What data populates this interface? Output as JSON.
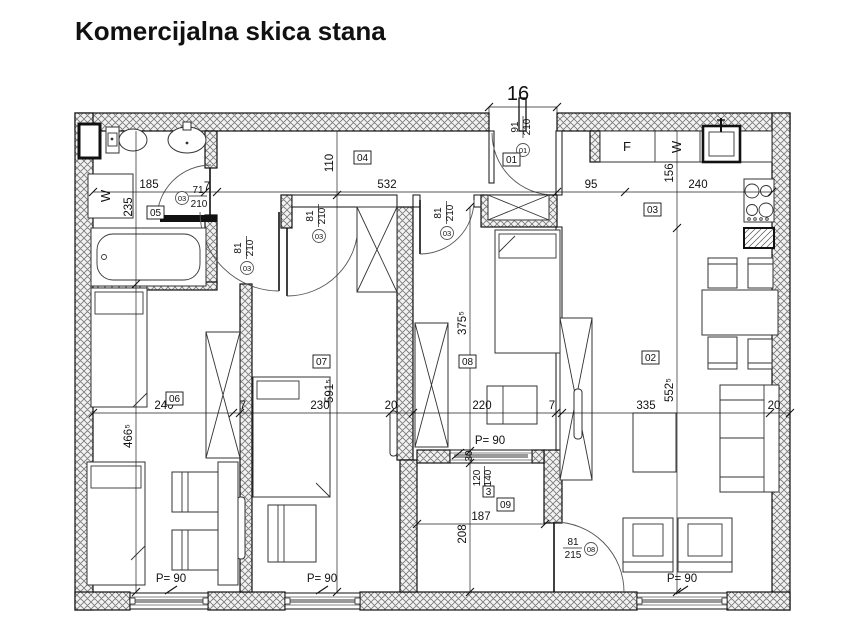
{
  "title": "Komercijalna skica stana",
  "apartment_number": "16",
  "rooms": {
    "r01": "01",
    "r02": "02",
    "r03": "03",
    "r04": "04",
    "r05": "05",
    "r06": "06",
    "r07": "07",
    "r08": "08",
    "r09": "09"
  },
  "doors": {
    "entrance": {
      "id": "01",
      "width": "91",
      "height": "210"
    },
    "bathroom": {
      "id": "03",
      "width": "71",
      "height": "210"
    },
    "room06": {
      "id": "03",
      "width": "81",
      "height": "210"
    },
    "room07": {
      "id": "03",
      "width": "81",
      "height": "210"
    },
    "room08": {
      "id": "03",
      "width": "81",
      "height": "210"
    },
    "balcony": {
      "id": "08",
      "width": "81",
      "height": "215"
    }
  },
  "window": {
    "id": "3",
    "width": "120",
    "height": "140",
    "wall": "30"
  },
  "parapet": "P= 90",
  "dims": {
    "top": [
      "185",
      "532",
      "95",
      "240"
    ],
    "main": [
      "240",
      "7",
      "230",
      "20",
      "220",
      "7",
      "335",
      "20"
    ],
    "bath_wall": "7",
    "bath_height": "235",
    "room06_height": "466⁵",
    "hall_height": "110",
    "room07_height": "591⁵",
    "room08_height": "375⁵",
    "balcony_height": "208",
    "balcony_width": "187",
    "kitchen_depth": "156",
    "living_height": "552⁵"
  },
  "appliances": {
    "fridge": "F",
    "washer": "W",
    "washer_bath": "W"
  }
}
